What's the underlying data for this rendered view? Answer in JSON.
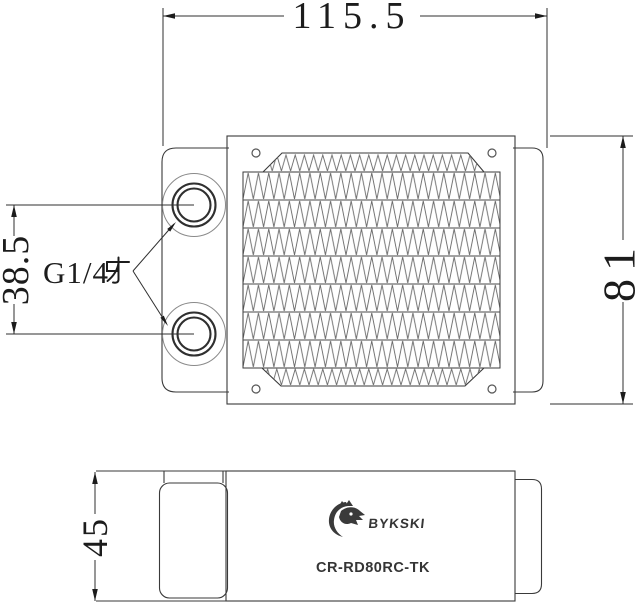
{
  "document": {
    "kind": "radiator technical drawing",
    "views": [
      "top-view",
      "side-view"
    ]
  },
  "dimensions": {
    "width": "115.5",
    "height": "81",
    "port_spacing": "38.5",
    "thickness": "45"
  },
  "labels": {
    "thread": "G1/4牙",
    "thread_latin": "G1/4"
  },
  "branding": {
    "brand": "BYKSKI",
    "model": "CR-RD80RC-TK",
    "logo_icon": "dragon-head-logo"
  },
  "colors": {
    "background": "#ffffff",
    "line": "#3a3a3a",
    "fin_line": "#666666",
    "dimension_text": "#1c1c1c",
    "logo": "#3a3a3a"
  }
}
